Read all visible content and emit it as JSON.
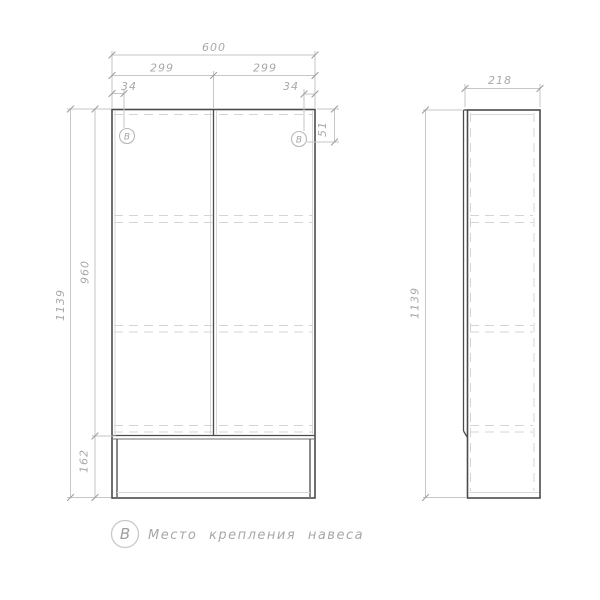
{
  "front_view": {
    "total_width": "600",
    "left_door_width": "299",
    "right_door_width": "299",
    "left_mount_offset": "34",
    "right_mount_offset": "34",
    "mount_top_offset": "51",
    "door_height": "960",
    "total_height": "1139",
    "niche_height": "162",
    "mount_symbol_left": "В",
    "mount_symbol_right": "В"
  },
  "side_view": {
    "depth": "218",
    "total_height": "1139"
  },
  "legend": {
    "symbol": "В",
    "text": "Место крепления навеса"
  },
  "colors": {
    "outline": "#4b4b4b",
    "dimension_lines": "#c6c6c6",
    "dimension_text": "#a9a9a9",
    "hidden_lines": "#d4d4d4"
  }
}
